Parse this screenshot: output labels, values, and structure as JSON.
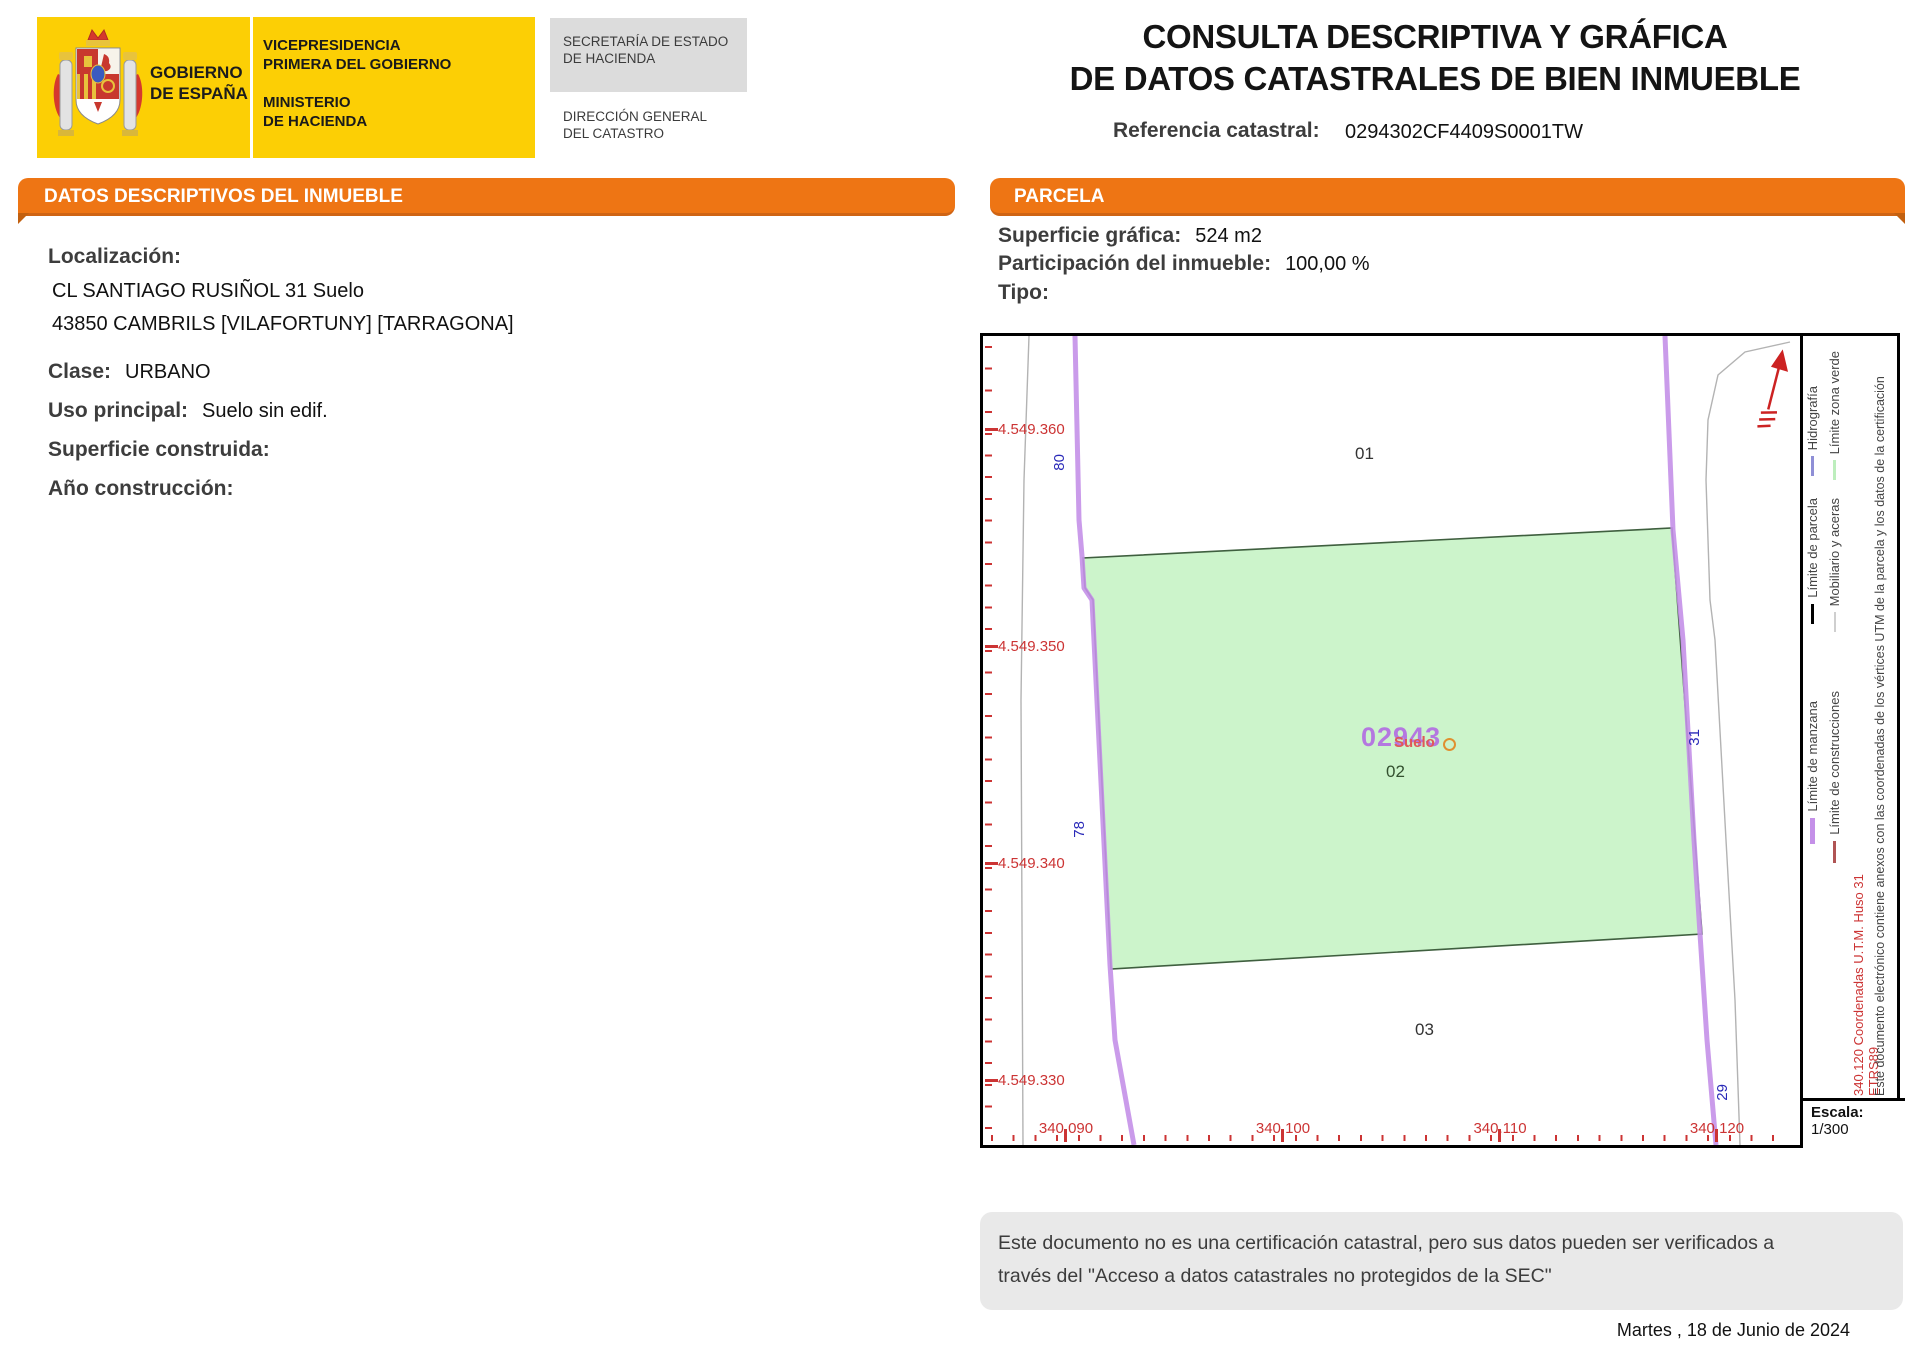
{
  "header": {
    "logo": {
      "gobierno_line1": "GOBIERNO",
      "gobierno_line2": "DE ESPAÑA",
      "vice_line1": "VICEPRESIDENCIA",
      "vice_line2": "PRIMERA DEL GOBIERNO",
      "min_line1": "MINISTERIO",
      "min_line2": "DE HACIENDA",
      "sec_line1": "SECRETARÍA DE ESTADO",
      "sec_line2": "DE HACIENDA",
      "dir_line1": "DIRECCIÓN GENERAL",
      "dir_line2": "DEL CATASTRO"
    },
    "title_line1": "CONSULTA DESCRIPTIVA Y GRÁFICA",
    "title_line2": "DE DATOS CATASTRALES DE BIEN INMUEBLE",
    "ref_label": "Referencia catastral:",
    "ref_value": "0294302CF4409S0001TW"
  },
  "datos": {
    "section_title": "DATOS DESCRIPTIVOS DEL INMUEBLE",
    "localizacion_label": "Localización:",
    "address_line1": "CL SANTIAGO RUSIÑOL 31 Suelo",
    "address_line2": "43850 CAMBRILS [VILAFORTUNY] [TARRAGONA]",
    "clase_label": "Clase:",
    "clase_value": "URBANO",
    "uso_label": "Uso principal:",
    "uso_value": "Suelo sin edif.",
    "superficie_label": "Superficie construida:",
    "superficie_value": "",
    "anio_label": "Año construcción:",
    "anio_value": ""
  },
  "parcela": {
    "section_title": "PARCELA",
    "superficie_label": "Superficie gráfica:",
    "superficie_value": "524 m2",
    "participacion_label": "Participación del inmueble:",
    "participacion_value": "100,00 %",
    "tipo_label": "Tipo:",
    "tipo_value": ""
  },
  "map": {
    "y_labels": [
      "4.549.360",
      "4.549.350",
      "4.549.340",
      "4.549.330"
    ],
    "x_labels": [
      "340.090",
      "340.100",
      "340.110",
      "340.120"
    ],
    "street_numbers": {
      "n80": "80",
      "n78": "78",
      "n31": "31",
      "n29": "29"
    },
    "area_labels": {
      "a01": "01",
      "a02": "02",
      "a03": "03"
    },
    "parcel_number": "02943",
    "parcel_subtext": "Suelo",
    "escala_label": "Escala:",
    "escala_value": "1/300",
    "legend": {
      "hidrografia": "Hidrografía",
      "parcela": "Límite de parcela",
      "manzana": "Límite de manzana",
      "zona_verde": "Límite zona verde",
      "aceras": "Mobiliario y aceras",
      "construcciones": "Límite de construcciones",
      "coords_note": "340.120 Coordenadas U.T.M. Huso 31 ETRS89",
      "cert_note": "Este documento electrónico contiene anexos con las coordenadas de los vértices UTM de la parcela y los datos de la certificación"
    },
    "geometry": {
      "parcel_points": "100,222 102,252 110,264 128,633 719,598 689,192",
      "purple_left": "92,0 96,184 99,220 101,252 109,264 127,629 132,704 151,809",
      "purple_right": "682,0 690,194 700,304 711,504 717,598 724,704 733,809",
      "gray_left": "46,0 41,144 38,364 40,809",
      "gray_right": "807,6 762,16 735,39 725,84 723,144 727,264 732,304 743,504 752,664 757,809"
    },
    "colors": {
      "parcel_fill": "#ccf4cb",
      "parcel_stroke": "#3f5f3f",
      "manzana_line": "#c490e8",
      "street_line": "#b3b3b3",
      "tick_red": "#cc3434",
      "street_number_blue": "#2929b8",
      "parcel_number_purple": "#b478e0",
      "orange_accent": "#ee7514"
    }
  },
  "footer": {
    "disclaimer_line1": "Este documento no es una certificación catastral, pero sus datos pueden ser verificados a",
    "disclaimer_line2": "través del \"Acceso a datos catastrales no protegidos de la SEC\"",
    "date": "Martes , 18 de Junio de 2024"
  }
}
